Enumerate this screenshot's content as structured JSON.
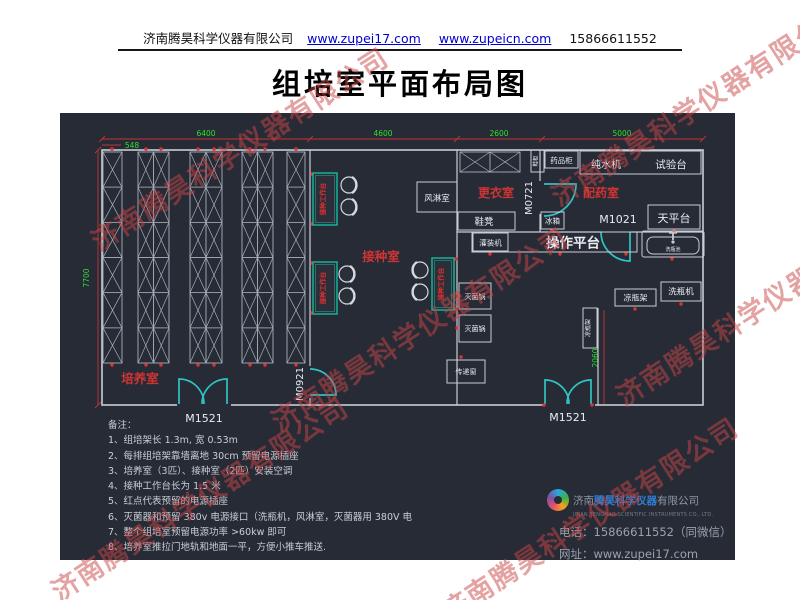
{
  "header": {
    "company": "济南腾昊科学仪器有限公司",
    "url1": "www.zupei17.com",
    "url2": "www.zupeicn.com",
    "phone": "15866611552"
  },
  "title": "组培室平面布局图",
  "watermark": {
    "text": "济南腾昊科学仪器有限公司"
  },
  "colors": {
    "panel_bg": "#262b36",
    "wall": "#c9cdd5",
    "dim_line_red": "#c63333",
    "dim_text_green": "#2ee02e",
    "door_cyan": "#2fc4c4",
    "room_label_red": "#d23434",
    "bench_teal": "#18b89c",
    "outlet_red": "#e23030",
    "link_blue": "#0000cc",
    "brand_blue": "#2f7fd6"
  },
  "plan": {
    "dims": {
      "top": [
        "6400",
        "4600",
        "2600",
        "5000"
      ],
      "sub": "548",
      "left": "7700",
      "right": "2060"
    },
    "rooms": {
      "culture": "培养室",
      "inoculation": "接种室",
      "changing": "更衣室",
      "dispensing": "配药室"
    },
    "doors": {
      "m1521": "M1521",
      "m0921": "M0921",
      "m0721": "M0721",
      "m1021": "M1021"
    },
    "equipment": {
      "air_shower": "风淋室",
      "shoe_cabinet": "鞋柜",
      "medicine_cabinet": "药品柜",
      "water_machine": "纯水机",
      "test_bench": "试验台",
      "fridge": "冰箱",
      "balance_table": "天平台",
      "shoe_bench": "鞋凳",
      "filling_machine": "灌装机",
      "operation_platform": "操作平台",
      "sterilizer": "灭菌锅",
      "transfer_window": "传递窗",
      "bottle_sink": "洗瓶池",
      "bottle_cool_rack": "凉瓶架",
      "bottle_washer": "洗瓶机",
      "inoculation_bench": "接种工作台"
    },
    "racks": [
      {
        "x": 43,
        "y": 39,
        "w": 19,
        "h": 211,
        "cols": 1,
        "rows": 6
      },
      {
        "x": 78,
        "y": 39,
        "w": 31,
        "h": 211,
        "cols": 2,
        "rows": 6
      },
      {
        "x": 130,
        "y": 39,
        "w": 32,
        "h": 211,
        "cols": 2,
        "rows": 6
      },
      {
        "x": 182,
        "y": 39,
        "w": 31,
        "h": 211,
        "cols": 2,
        "rows": 6
      },
      {
        "x": 227,
        "y": 39,
        "w": 18,
        "h": 211,
        "cols": 1,
        "rows": 6
      },
      {
        "x": 400,
        "y": 39,
        "w": 60,
        "h": 20,
        "cols": 2,
        "rows": 1
      }
    ],
    "outlets": [
      [
        52,
        36
      ],
      [
        86,
        36
      ],
      [
        101,
        36
      ],
      [
        138,
        36
      ],
      [
        154,
        36
      ],
      [
        190,
        36
      ],
      [
        205,
        36
      ],
      [
        236,
        36
      ],
      [
        52,
        252
      ],
      [
        86,
        252
      ],
      [
        101,
        252
      ],
      [
        138,
        252
      ],
      [
        154,
        252
      ],
      [
        190,
        252
      ],
      [
        205,
        252
      ],
      [
        236,
        252
      ],
      [
        252,
        61
      ],
      [
        252,
        111
      ],
      [
        252,
        150
      ],
      [
        252,
        200
      ],
      [
        396,
        146
      ],
      [
        396,
        196
      ],
      [
        430,
        141
      ],
      [
        500,
        141
      ],
      [
        566,
        141
      ],
      [
        397,
        183
      ],
      [
        397,
        215
      ],
      [
        401,
        244
      ],
      [
        612,
        146
      ],
      [
        575,
        196
      ],
      [
        621,
        191
      ],
      [
        614,
        118
      ],
      [
        492,
        118
      ],
      [
        484,
        292
      ],
      [
        532,
        292
      ]
    ],
    "stools": [
      [
        289,
        72,
        1
      ],
      [
        289,
        94,
        1
      ],
      [
        287,
        161,
        1
      ],
      [
        287,
        183,
        1
      ],
      [
        360,
        157,
        -1
      ],
      [
        360,
        179,
        -1
      ]
    ]
  },
  "notes": {
    "title": "备注：",
    "items": [
      "1、组培架长 1.3m, 宽 0.53m",
      "2、每排组培架靠墙离地 30cm 预留电源插座",
      "3、培养室（3匹）、接种室（2匹）安装空调",
      "4、接种工作台长为 1.5 米",
      "5、红点代表预留的电源插座",
      "6、灭菌器和预留 380v 电源接口（洗瓶机，风淋室，灭菌器用 380V 电",
      "7、整个组培室预留电源功率 >60kw 即可",
      "8、培养室推拉门地轨和地面一平，方便小推车推送."
    ]
  },
  "footer": {
    "company_prefix": "济南",
    "company_brand": "腾昊",
    "company_mid": "科学仪器",
    "company_suffix": "有限公司",
    "company_en": "JINAN TENGHAO SCIENTIFIC INSTRUMENTS CO., LTD.",
    "phone_label": "电话：",
    "phone": "15866611552（同微信）",
    "web_label": "网址：",
    "web": "www.zupei17.com"
  }
}
